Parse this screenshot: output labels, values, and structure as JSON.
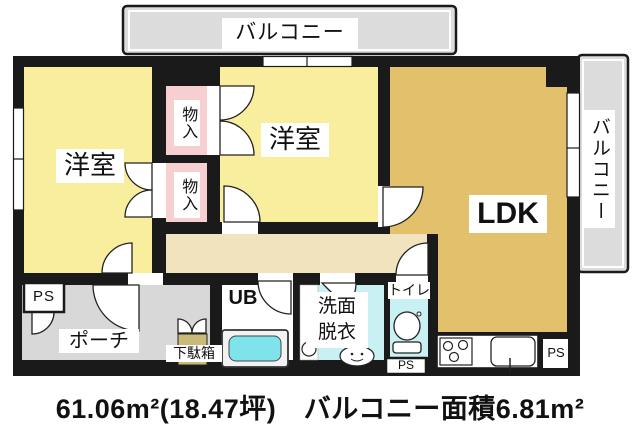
{
  "labels": {
    "balcony_top": "バルコニー",
    "balcony_right": "バルコニー",
    "bedroom_left": "洋室",
    "bedroom_center": "洋室",
    "closet_upper": "物入",
    "closet_lower": "物入",
    "ldk": "LDK",
    "porch": "ポーチ",
    "shoe_cabinet": "下駄箱",
    "unit_bath": "UB",
    "washroom_line1": "洗面",
    "washroom_line2": "脱衣",
    "toilet": "トイレ",
    "ps_left": "PS",
    "ps_toilet": "PS",
    "ps_kitchen": "PS"
  },
  "area_text": "61.06m²(18.47坪)　バルコニー面積6.81m²",
  "colors": {
    "wall": "#1a1a1a",
    "bedroom": "#F8EE9E",
    "ldk": "#E3C06C",
    "hallway": "#F1E3BD",
    "closet": "#F7CFD0",
    "wet_floor": "#C9F0F2",
    "bathtub": "#7FE3EC",
    "gray_floor": "#D8D8D8",
    "balcony": "#DCDCDC",
    "shoe_cabinet": "#C9BA77",
    "opening": "#FFFFFF"
  }
}
